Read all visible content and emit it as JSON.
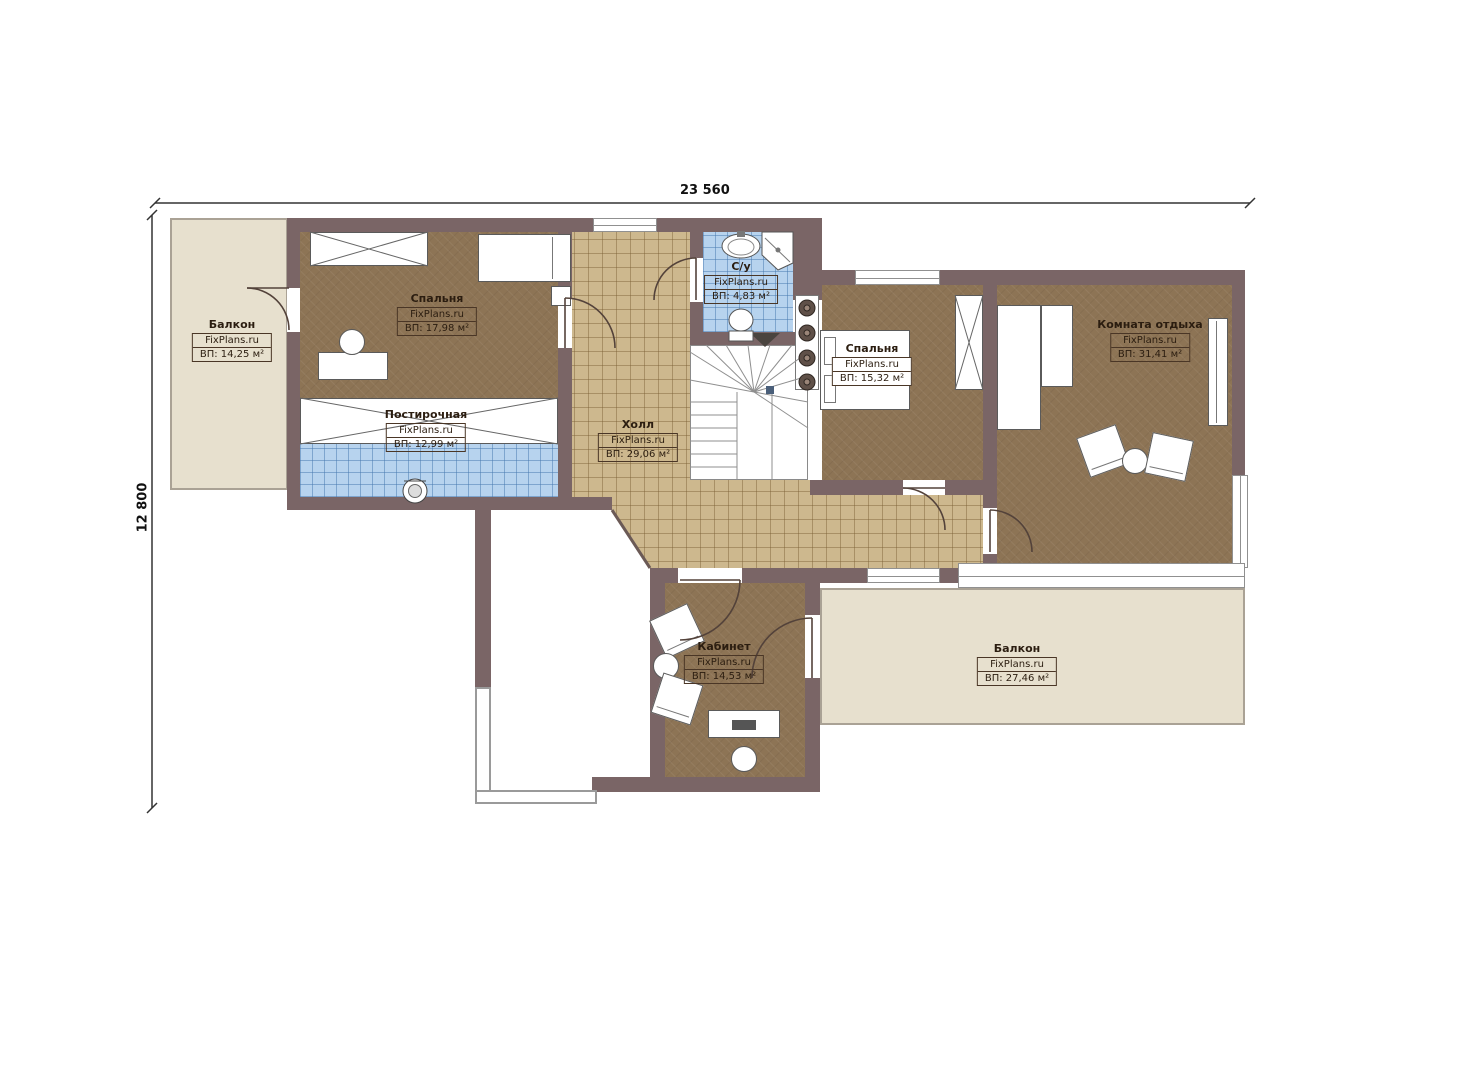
{
  "dimensions": {
    "width": "23 560",
    "height": "12 800"
  },
  "rooms": [
    {
      "key": "balcony_left",
      "name": "Балкон",
      "watermark": "FixPlans.ru",
      "area": "ВП: 14,25 м²"
    },
    {
      "key": "bedroom_1",
      "name": "Спальня",
      "watermark": "FixPlans.ru",
      "area": "ВП: 17,98 м²"
    },
    {
      "key": "laundry",
      "name": "Постирочная",
      "watermark": "FixPlans.ru",
      "area": "ВП: 12,99 м²"
    },
    {
      "key": "hall",
      "name": "Холл",
      "watermark": "FixPlans.ru",
      "area": "ВП: 29,06 м²"
    },
    {
      "key": "bathroom",
      "name": "С/у",
      "watermark": "FixPlans.ru",
      "area": "ВП: 4,83 м²"
    },
    {
      "key": "bedroom_2",
      "name": "Спальня",
      "watermark": "FixPlans.ru",
      "area": "ВП: 15,32 м²"
    },
    {
      "key": "lounge",
      "name": "Комната отдыха",
      "watermark": "FixPlans.ru",
      "area": "ВП: 31,41 м²"
    },
    {
      "key": "office",
      "name": "Кабинет",
      "watermark": "FixPlans.ru",
      "area": "ВП: 14,53 м²"
    },
    {
      "key": "balcony_bottom",
      "name": "Балкон",
      "watermark": "FixPlans.ru",
      "area": "ВП: 27,46 м²"
    }
  ],
  "colors": {
    "wall": "#7a6566",
    "room_floor": "#8d7455",
    "hall_tile": "#cdb88e",
    "wet_tile": "#b7d3ee",
    "balcony": "#e7e0ce"
  }
}
